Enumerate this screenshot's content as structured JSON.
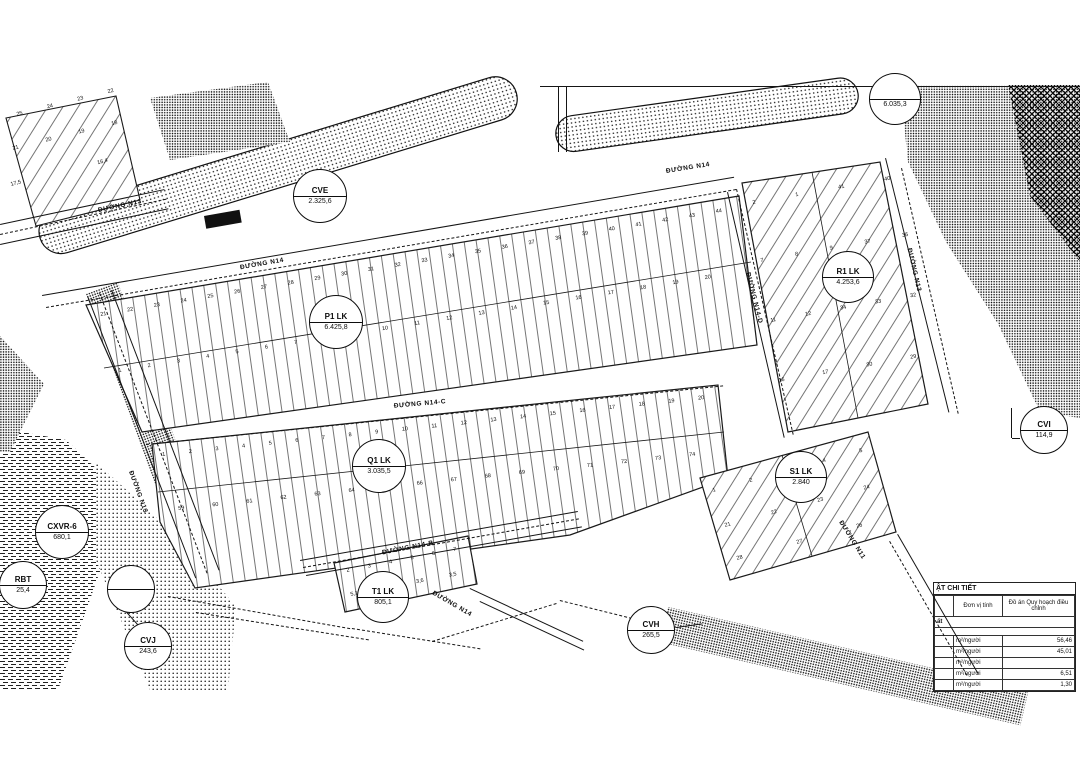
{
  "drawing": {
    "balloons": [
      {
        "name": "CVE",
        "value": "2.325,6",
        "x": 320,
        "y": 196,
        "r": 27
      },
      {
        "name": "P1 LK",
        "value": "6.425,8",
        "x": 336,
        "y": 322,
        "r": 27
      },
      {
        "name": "Q1 LK",
        "value": "3.035,5",
        "x": 379,
        "y": 466,
        "r": 27
      },
      {
        "name": "R1 LK",
        "value": "4.253,6",
        "x": 848,
        "y": 277,
        "r": 26
      },
      {
        "name": "S1 LK",
        "value": "2.840",
        "x": 801,
        "y": 477,
        "r": 26
      },
      {
        "name": "T1 LK",
        "value": "805,1",
        "x": 383,
        "y": 597,
        "r": 26
      },
      {
        "name": "CVH",
        "value": "265,5",
        "x": 651,
        "y": 630,
        "r": 24
      },
      {
        "name": "CVI",
        "value": "114,9",
        "x": 1044,
        "y": 430,
        "r": 24
      },
      {
        "name": "CVJ",
        "value": "243,6",
        "x": 148,
        "y": 646,
        "r": 24
      },
      {
        "name": "CXVR-6",
        "value": "680,1",
        "x": 62,
        "y": 532,
        "r": 27
      },
      {
        "name": "RBT",
        "value": "25,4",
        "x": 23,
        "y": 585,
        "r": 24
      },
      {
        "name": "",
        "value": "",
        "x": 131,
        "y": 589,
        "r": 24
      },
      {
        "name": "",
        "value": "6.035,3",
        "x": 895,
        "y": 99,
        "r": 26
      }
    ],
    "road_labels": [
      {
        "text": "ĐƯỜNG N13",
        "x": 120,
        "y": 206,
        "rot": -12
      },
      {
        "text": "ĐƯỜNG N14",
        "x": 262,
        "y": 264,
        "rot": -10
      },
      {
        "text": "ĐƯỜNG N14",
        "x": 688,
        "y": 168,
        "rot": -9
      },
      {
        "text": "ĐƯỜNG N14-C",
        "x": 420,
        "y": 404,
        "rot": -5
      },
      {
        "text": "ĐƯỜNG N14-B",
        "x": 408,
        "y": 548,
        "rot": -11
      },
      {
        "text": "ĐƯỜNG N14",
        "x": 452,
        "y": 604,
        "rot": 30
      },
      {
        "text": "ĐƯỜNG N14-D",
        "x": 754,
        "y": 298,
        "rot": 76
      },
      {
        "text": "ĐƯỜNG N13",
        "x": 914,
        "y": 270,
        "rot": 77
      },
      {
        "text": "ĐƯỜNG N11",
        "x": 852,
        "y": 540,
        "rot": 58
      },
      {
        "text": "ĐƯỜNG N13",
        "x": 138,
        "y": 492,
        "rot": 70
      }
    ],
    "lot_rows": [
      {
        "x": 16,
        "y": 112,
        "len": 100,
        "rot": -14,
        "nums": [
          "25",
          "24",
          "23",
          "22"
        ]
      },
      {
        "x": 12,
        "y": 146,
        "len": 108,
        "rot": -14,
        "nums": [
          "21",
          "20",
          "19",
          "18"
        ]
      },
      {
        "x": 10,
        "y": 182,
        "len": 100,
        "rot": -14,
        "nums": [
          "17,5",
          "16,4"
        ]
      },
      {
        "x": 100,
        "y": 312,
        "len": 630,
        "rot": -9.5,
        "nums": [
          "21",
          "22",
          "23",
          "24",
          "25",
          "26",
          "27",
          "28",
          "29",
          "30",
          "31",
          "32",
          "33",
          "34",
          "35",
          "36",
          "37",
          "38",
          "39",
          "40",
          "41",
          "42",
          "43",
          "44"
        ]
      },
      {
        "x": 118,
        "y": 368,
        "len": 600,
        "rot": -9,
        "nums": [
          "1",
          "2",
          "3",
          "4",
          "5",
          "6",
          "7",
          "8",
          "9",
          "10",
          "11",
          "12",
          "13",
          "14",
          "15",
          "16",
          "17",
          "18",
          "19",
          "20"
        ]
      },
      {
        "x": 162,
        "y": 452,
        "len": 545,
        "rot": -6,
        "nums": [
          "1",
          "2",
          "3",
          "4",
          "5",
          "6",
          "7",
          "8",
          "9",
          "10",
          "11",
          "12",
          "13",
          "14",
          "15",
          "16",
          "17",
          "18",
          "19",
          "20"
        ]
      },
      {
        "x": 178,
        "y": 506,
        "len": 520,
        "rot": -6,
        "nums": [
          "59",
          "60",
          "61",
          "62",
          "63",
          "64",
          "65",
          "66",
          "67",
          "68",
          "69",
          "70",
          "71",
          "72",
          "73",
          "74"
        ]
      },
      {
        "x": 752,
        "y": 200,
        "len": 140,
        "rot": -10,
        "nums": [
          "2",
          "1",
          "41",
          "40"
        ]
      },
      {
        "x": 760,
        "y": 258,
        "len": 150,
        "rot": -10,
        "nums": [
          "7",
          "8",
          "9",
          "37",
          "36"
        ]
      },
      {
        "x": 770,
        "y": 318,
        "len": 148,
        "rot": -10,
        "nums": [
          "11",
          "12",
          "34",
          "33",
          "32"
        ]
      },
      {
        "x": 778,
        "y": 378,
        "len": 140,
        "rot": -10,
        "nums": [
          "16",
          "17",
          "30",
          "29"
        ]
      },
      {
        "x": 712,
        "y": 488,
        "len": 155,
        "rot": -15,
        "nums": [
          "1",
          "2",
          "3",
          "4",
          "5"
        ]
      },
      {
        "x": 724,
        "y": 523,
        "len": 150,
        "rot": -15,
        "nums": [
          "21",
          "22",
          "23",
          "24"
        ]
      },
      {
        "x": 736,
        "y": 556,
        "len": 130,
        "rot": -15,
        "nums": [
          "28",
          "27",
          "26"
        ]
      },
      {
        "x": 346,
        "y": 568,
        "len": 112,
        "rot": -11,
        "nums": [
          "2",
          "3",
          "4",
          "5",
          "6",
          "7"
        ]
      },
      {
        "x": 350,
        "y": 592,
        "len": 108,
        "rot": -11,
        "nums": [
          "5,1",
          "3,7",
          "3,6",
          "3,5"
        ]
      }
    ],
    "lines": [
      {
        "x": 0,
        "y": 224,
        "len": 168,
        "rot": -12
      },
      {
        "x": 0,
        "y": 244,
        "len": 172,
        "rot": -12
      },
      {
        "x": 0,
        "y": 234,
        "len": 170,
        "rot": -12,
        "dash": true
      },
      {
        "x": 42,
        "y": 295,
        "len": 702,
        "rot": -9.7
      },
      {
        "x": 46,
        "y": 307,
        "len": 700,
        "rot": -9.7,
        "dash": true
      },
      {
        "x": 146,
        "y": 444,
        "len": 580,
        "rot": -5.8,
        "dash": true
      },
      {
        "x": 300,
        "y": 560,
        "len": 282,
        "rot": -10
      },
      {
        "x": 306,
        "y": 575,
        "len": 280,
        "rot": -10
      },
      {
        "x": 303,
        "y": 567,
        "len": 280,
        "rot": -10,
        "dash": true
      },
      {
        "x": 88,
        "y": 296,
        "len": 302,
        "rot": 69
      },
      {
        "x": 112,
        "y": 290,
        "len": 300,
        "rot": 69
      },
      {
        "x": 100,
        "y": 293,
        "len": 300,
        "rot": 69,
        "dash": true
      },
      {
        "x": 728,
        "y": 192,
        "len": 252,
        "rot": 77
      },
      {
        "x": 737,
        "y": 189,
        "len": 252,
        "rot": 77,
        "dash": true
      },
      {
        "x": 886,
        "y": 158,
        "len": 262,
        "rot": 76
      },
      {
        "x": 902,
        "y": 168,
        "len": 252,
        "rot": 77,
        "dash": true
      },
      {
        "x": 898,
        "y": 534,
        "len": 162,
        "rot": 60
      },
      {
        "x": 890,
        "y": 541,
        "len": 155,
        "rot": 60,
        "dash": true
      },
      {
        "x": 470,
        "y": 588,
        "len": 125,
        "rot": 25
      },
      {
        "x": 480,
        "y": 601,
        "len": 115,
        "rot": 25
      },
      {
        "x": 168,
        "y": 596,
        "len": 185,
        "rot": 10,
        "dash": true
      },
      {
        "x": 196,
        "y": 612,
        "len": 175,
        "rot": 9,
        "dash": true
      },
      {
        "x": 352,
        "y": 628,
        "len": 130,
        "rot": 9,
        "dash": true
      },
      {
        "x": 432,
        "y": 641,
        "len": 130,
        "rot": -17,
        "dash": true
      },
      {
        "x": 560,
        "y": 600,
        "len": 110,
        "rot": 14,
        "dash": true
      },
      {
        "x": 540,
        "y": 86,
        "len": 540,
        "rot": 0
      },
      {
        "x": 559,
        "y": 86,
        "len": 66,
        "rot": 90
      },
      {
        "x": 567,
        "y": 86,
        "len": 66,
        "rot": 90
      },
      {
        "x": 1012,
        "y": 408,
        "len": 30,
        "rot": 90
      },
      {
        "x": 1012,
        "y": 438,
        "len": 8,
        "rot": 0
      },
      {
        "x": 118,
        "y": 602,
        "len": 56,
        "rot": 48
      },
      {
        "x": 676,
        "y": 627,
        "len": 26,
        "rot": -8
      }
    ]
  },
  "legend_table": {
    "title": "ẬT CHI TIẾT",
    "col_unit": "Đơn vị tính",
    "col_value": "Đồ án Quy hoạch điều chỉnh",
    "section": "ất",
    "rows": [
      {
        "unit": "m²/người",
        "value": "56,46"
      },
      {
        "unit": "m²/người",
        "value": "45,01"
      },
      {
        "unit": "m²/người",
        "value": ""
      },
      {
        "unit": "m²/người",
        "value": "6,51"
      },
      {
        "unit": "m²/người",
        "value": "1,30"
      }
    ]
  }
}
